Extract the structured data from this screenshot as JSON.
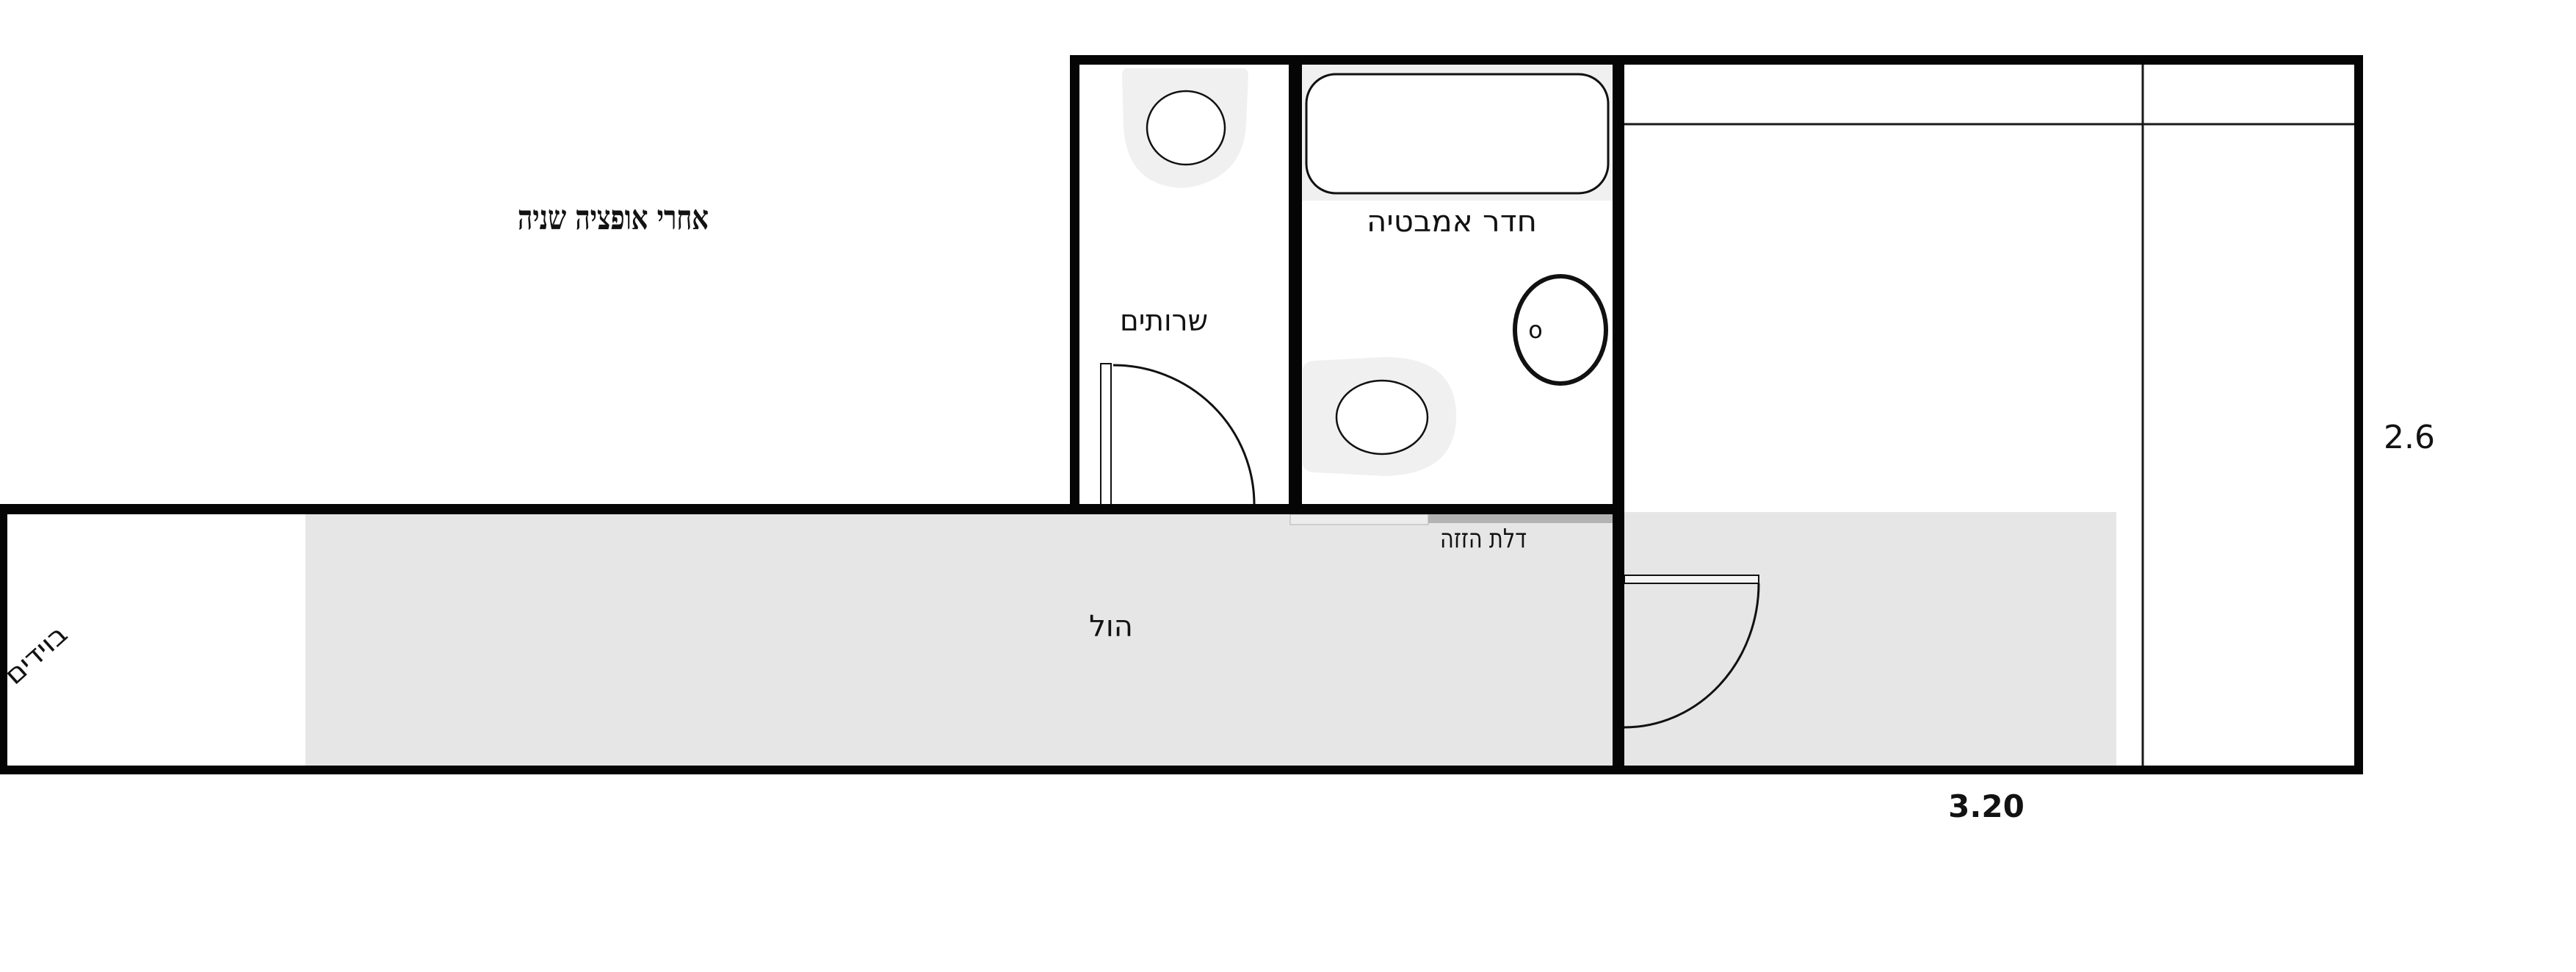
{
  "title": "אחרי אופציה שניה",
  "rooms": {
    "toilet": {
      "label": "שרותים"
    },
    "bathroom": {
      "label": "חדר אמבטיה"
    },
    "hall": {
      "label": "הול"
    },
    "boydem": {
      "label": "בוידים"
    }
  },
  "labels": {
    "sliding_door": "דלת הזזה",
    "washer_mark": "o"
  },
  "dimensions": {
    "right_side_height": "2.6",
    "bottom_width": "3.20"
  },
  "colors": {
    "wall": "#050505",
    "floor": "#e6e6e6",
    "fixture_bg": "#f0f0f0",
    "sliding_door_bar": "#b3b3b3",
    "sliding_door_pocket": "#ececec",
    "door_leaf_fill": "#f5f5f5"
  }
}
